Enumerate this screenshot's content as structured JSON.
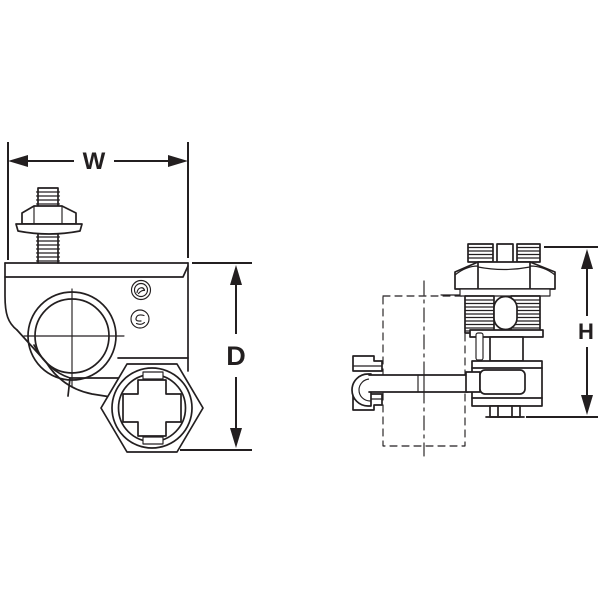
{
  "diagram": {
    "background_color": "#ffffff",
    "line_color": "#231f20",
    "labels": {
      "width": "W",
      "depth": "D",
      "height": "H"
    }
  }
}
